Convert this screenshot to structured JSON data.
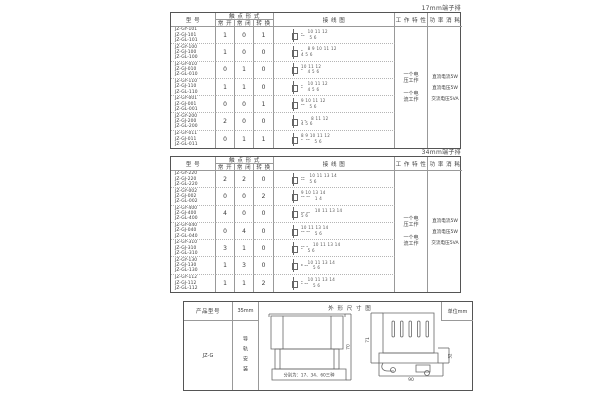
{
  "table_headers": {
    "model": "型 号",
    "contact_form": "触 点 形 式",
    "no": "常 开",
    "nc": "常 闭",
    "co": "转 换",
    "wiring": "接 线 图",
    "work": "工 作 特 性",
    "power": "功 率 消 耗"
  },
  "work_power": {
    "work_voltage": "一个电\n压工作",
    "work_current": "一个电\n流工作",
    "power_lines": [
      "直流电流5W",
      "直流电压5W",
      "交流电压5VA"
    ]
  },
  "tables": [
    {
      "terminal_label": "17mm端子排",
      "rows": [
        {
          "models": [
            "JZ-GY-101",
            "JZ-GJ-101",
            "JZ-GL-101"
          ],
          "no": "1",
          "nc": "0",
          "co": "1",
          "diagram_top": "⎵   10 11 12",
          "diagram_bottom": "⎴⎴   5 6"
        },
        {
          "models": [
            "JZ-GY-100",
            "JZ-GJ-100",
            "JZ-GL-100"
          ],
          "no": "1",
          "nc": "0",
          "co": "0",
          "diagram_top": "⎵   8 9 10 11 12",
          "diagram_bottom": "4 5 6"
        },
        {
          "models": [
            "JZ-GY-010",
            "JZ-GJ-010",
            "JZ-GL-010"
          ],
          "no": "0",
          "nc": "1",
          "co": "0",
          "diagram_top": "10 11 12",
          "diagram_bottom": "⎴   4 5 6"
        },
        {
          "models": [
            "JZ-GY-110",
            "JZ-GJ-110",
            "JZ-GL-110"
          ],
          "no": "1",
          "nc": "1",
          "co": "0",
          "diagram_top": "⎵   10 11 12",
          "diagram_bottom": "⎴   4 5 6"
        },
        {
          "models": [
            "JZ-GY-001",
            "JZ-GJ-001",
            "JZ-GL-001"
          ],
          "no": "0",
          "nc": "0",
          "co": "1",
          "diagram_top": "9 10 11 12",
          "diagram_bottom": "⎴⎴   5 6"
        },
        {
          "models": [
            "JZ-GY-200",
            "JZ-GJ-200",
            "JZ-GL-200"
          ],
          "no": "2",
          "nc": "0",
          "co": "0",
          "diagram_top": "⎵ ⎵   8 11 12",
          "diagram_bottom": "4 5 6"
        },
        {
          "models": [
            "JZ-GY-011",
            "JZ-GJ-011",
            "JZ-GL-011"
          ],
          "no": "0",
          "nc": "1",
          "co": "1",
          "diagram_top": "8 9 10 11 12",
          "diagram_bottom": "⎴  ⎴⎴   5 6"
        }
      ]
    },
    {
      "terminal_label": "34mm端子排",
      "rows": [
        {
          "models": [
            "JZ-GY-220",
            "JZ-GJ-220",
            "JZ-GL-220"
          ],
          "no": "2",
          "nc": "2",
          "co": "0",
          "diagram_top": "⎵⎵   10 11 13 14",
          "diagram_bottom": "⎴⎴   5 6"
        },
        {
          "models": [
            "JZ-GY-002",
            "JZ-GJ-002",
            "JZ-GL-002"
          ],
          "no": "0",
          "nc": "0",
          "co": "2",
          "diagram_top": "9 10 13 14",
          "diagram_bottom": "⎴⎴ ⎴⎴   1 4"
        },
        {
          "models": [
            "JZ-GY-400",
            "JZ-GJ-400",
            "JZ-GL-400"
          ],
          "no": "4",
          "nc": "0",
          "co": "0",
          "diagram_top": "⎵⎵ ⎵⎵   10 11 13 14",
          "diagram_bottom": "5 6"
        },
        {
          "models": [
            "JZ-GY-040",
            "JZ-GJ-040",
            "JZ-GL-040"
          ],
          "no": "0",
          "nc": "4",
          "co": "0",
          "diagram_top": "10 11 13 14",
          "diagram_bottom": "⎴⎴ ⎴⎴   5 6"
        },
        {
          "models": [
            "JZ-GY-310",
            "JZ-GJ-310",
            "JZ-GL-310"
          ],
          "no": "3",
          "nc": "1",
          "co": "0",
          "diagram_top": "⎵⎵ ⎵   10 11 13 14",
          "diagram_bottom": "⎴   5 6"
        },
        {
          "models": [
            "JZ-GY-130",
            "JZ-GJ-130",
            "JZ-GL-130"
          ],
          "no": "1",
          "nc": "3",
          "co": "0",
          "diagram_top": "⎵   10 11 13 14",
          "diagram_bottom": "⎴ ⎴⎴   5 6"
        },
        {
          "models": [
            "JZ-GY-112",
            "JZ-GJ-112",
            "JZ-GL-112"
          ],
          "no": "1",
          "nc": "1",
          "co": "2",
          "diagram_top": "⎵   10 11 13 14",
          "diagram_bottom": "⎴ ⎴⎴   5 6"
        }
      ]
    }
  ],
  "bottom": {
    "product_header": "产品型号",
    "dim_header": "外 形 尺 寸 图",
    "unit": "单位mm",
    "model": "JZ-G",
    "rail_size": "35mm",
    "rail_text": "导轨安装",
    "annotation": "分别为：17、34、60三种",
    "front_height": "70",
    "side_height": "71",
    "side_step": "32",
    "side_width": "90"
  }
}
